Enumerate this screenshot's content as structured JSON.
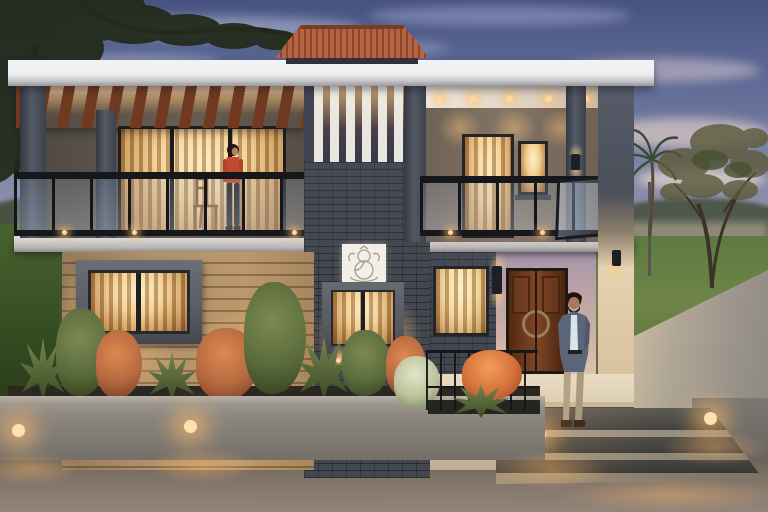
{
  "scene": {
    "type": "architectural-exterior-render",
    "time_of_day": "dusk",
    "description": "Photorealistic dusk rendering of a modern two-storey house: white flat roof with terracotta tiled cap, wooden pergola over a glass-railed balcony where a woman in an orange top stands by a chair, a dark brick central tower with a white Ganesha plaque and warm lit windows, beige lap-siding ground floor, wooden double entrance door, and a bearded man in a grey blazer standing on the lit porch steps beside a landscaped planter with uplights, cobblestone forecourt, lawn, palm and trees in the background."
  },
  "people": {
    "woman_on_balcony": {
      "top": "orange",
      "pants": "dark jeans"
    },
    "man_near_entrance": {
      "jacket": "grey blazer",
      "shirt": "light blue",
      "pants": "khaki",
      "shoes": "brown"
    }
  },
  "palette": {
    "sky_top": "#485480",
    "sky_mid": "#8087a8",
    "sky_horizon": "#d8bba6",
    "hill_green": "#46523f",
    "lawn_green": "#4c6636",
    "driveway_gray": "#99938b",
    "cobble_brown": "#6e6257",
    "roof_white": "#eceef0",
    "tile_terracotta": "#a6593a",
    "pergola_wood": "#713a20",
    "warm_glow": "#ffd9a2",
    "stucco_dark": "#3f4450",
    "brick_dark": "#43474f",
    "siding_beige": "#d3bfa3",
    "frame_dark": "#26282c",
    "door_wood": "#6e3b22",
    "column_lit": "#e6d2b0",
    "plaque_white": "#f2efe8",
    "plant_green": "#5a6b3c",
    "plant_rust": "#b5673f",
    "woman_top_orange": "#c0492f",
    "man_blazer_gray": "#5a6577",
    "man_shirt_light": "#d9e4ec",
    "man_pants_khaki": "#b3a284"
  },
  "objects": [
    "dusk-sky",
    "clouds",
    "distant-hills",
    "lawn",
    "driveway",
    "left-tree",
    "palm-tree",
    "right-tree",
    "flat-roof-slab",
    "terracotta-roof-cap",
    "pergola",
    "left-balcony",
    "glass-railing",
    "woman-on-balcony",
    "balcony-chair",
    "central-brick-tower",
    "white-slat-screen",
    "ganesha-plaque",
    "upper-center-window",
    "right-balcony",
    "balcony-door",
    "balcony-window",
    "ceiling-downlights",
    "wall-sconces",
    "corner-column",
    "siding-wall",
    "ground-left-window",
    "entry-window",
    "main-entrance-door",
    "porch",
    "entrance-steps",
    "planter-wall",
    "planter-lights",
    "garden-shrubs",
    "entry-railing",
    "orange-flower-plant",
    "man-near-entrance",
    "cobblestone-paving"
  ]
}
